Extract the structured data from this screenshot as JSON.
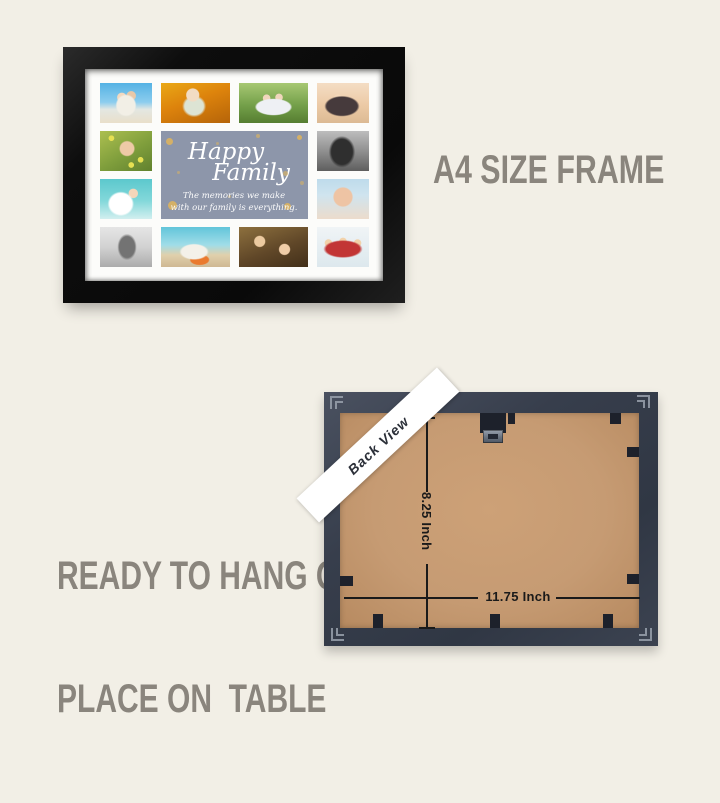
{
  "theme": {
    "page_bg": "#f2efe6",
    "mat_white": "#fcfcfa",
    "panel_blue": "#8d96aa",
    "gold": "#d4b067",
    "caption_gray": "#8a857d",
    "board_tan": "#c69b73",
    "clip_dark": "#1d212b",
    "line_dark": "#1a1a1a",
    "ribbon_white": "#ffffff",
    "ribbon_text": "#2b2f38",
    "metal": "#9aa2ad"
  },
  "front": {
    "panel": {
      "title_line1": "Happy",
      "title_line2": "Family",
      "subtitle_line1": "The memories we make",
      "subtitle_line2": "with our family is everything."
    },
    "photos": [
      {
        "name": "beach-couple",
        "style": "background:radial-gradient(ellipse 15px 16px at 50% 56%,#f2efe6 0 60%,transparent 70%),radial-gradient(circle 5px at 42% 36%,#f3d9c0 0 88%,transparent),radial-gradient(circle 5px at 60% 32%,#e8c8a8 0 88%,transparent),linear-gradient(180deg,#55b2e4 0%,#8ccdee 48%,#e3e7e2 66%,#e9dfca 100%)"
      },
      {
        "name": "autumn-toddler",
        "style": "background:radial-gradient(circle 7px at 46% 30%,#f2dcc4 0 88%,transparent),radial-gradient(ellipse 12px 11px at 48% 58%,#dde4d4 0 78%,transparent),linear-gradient(160deg,#eaa816 0%,#dd830c 45%,#b56409 100%)"
      },
      {
        "name": "park-family",
        "style": "background:radial-gradient(ellipse 24px 11px at 50% 60%,#eef0f4 0 70%,transparent 78%),radial-gradient(circle 4px at 40% 38%,#f0d6bc 0 88%,transparent),radial-gradient(circle 4px at 58% 36%,#f0d6bc 0 88%,transparent),linear-gradient(180deg,#a7c873 0%,#74a04a 55%,#567e31 100%)"
      },
      {
        "name": "beach-family-sunset",
        "style": "background:radial-gradient(ellipse 22px 13px at 48% 58%,#463a3c 0 70%,transparent 80%),radial-gradient(circle 4px at 40% 38%,#f4d8ba 0 88%,transparent),linear-gradient(180deg,#f4ddc4 0%,#eccaa6 55%,#dcba94 100%)"
      },
      {
        "name": "flower-girl",
        "style": "background:radial-gradient(circle 8px at 52% 44%,#eecaa6 0 85%,transparent),radial-gradient(circle 3px at 22% 18%,#e6e052 0 88%,transparent),radial-gradient(circle 3px at 78% 72%,#e6e052 0 88%,transparent),radial-gradient(circle 3px at 60% 85%,#e6e052 0 88%,transparent),linear-gradient(150deg,#acbf50 0%,#7f9e3c 55%,#61812e 100%)"
      },
      {
        "name": "bw-kissing-couple",
        "style": "background:radial-gradient(ellipse 15px 18px at 48% 52%,#2f2f2f 0 70%,transparent 88%),linear-gradient(180deg,#bdbdbd 0%,#909090 50%,#5e5e5e 100%)"
      },
      {
        "name": "mom-and-baby",
        "style": "background:radial-gradient(ellipse 15px 14px at 40% 62%,#ffffff 0 75%,transparent 88%),radial-gradient(circle 5px at 64% 36%,#f5d6ba 0 88%,transparent),linear-gradient(180deg,#5cc8cd 0%,#83d8da 55%,#d2efef 100%)"
      },
      {
        "name": "thinking-baby",
        "style": "background:radial-gradient(circle 11px at 50% 45%,#eec4a4 0 82%,transparent 92%),linear-gradient(180deg,#bedbeb 0%,#cfe4ef 40%,#ecdccc 100%)"
      },
      {
        "name": "bw-field-couple",
        "style": "background:radial-gradient(ellipse 11px 15px at 52% 50%,#737373 0 70%,transparent 88%),linear-gradient(180deg,#e5e5e5 0%,#d2d2d2 50%,#ababab 100%)"
      },
      {
        "name": "beach-pillow-couple",
        "style": "background:radial-gradient(ellipse 18px 10px at 48% 62%,#f4f1e9 0 70%,transparent 82%),radial-gradient(ellipse 11px 6px at 56% 82%,#ea7a2e 0 80%,transparent 92%),linear-gradient(180deg,#62c5da 0%,#a0dde8 45%,#e0d0ac 70%,#cfb893 100%)"
      },
      {
        "name": "autumn-kids",
        "style": "background:radial-gradient(circle 6px at 30% 36%,#eccaa0 0 86%,transparent),radial-gradient(circle 6px at 66% 56%,#f0cda8 0 86%,transparent),linear-gradient(160deg,#8d703e 0%,#604728 55%,#422f19 100%)"
      },
      {
        "name": "red-pajama-family",
        "style": "background:radial-gradient(ellipse 24px 11px at 50% 55%,#c23535 0 70%,transparent 82%),radial-gradient(circle 4px at 22% 40%,#f2d2aa 0 86%,transparent),radial-gradient(circle 4px at 50% 36%,#f2d2aa 0 86%,transparent),radial-gradient(circle 4px at 78% 40%,#f2d2aa 0 86%,transparent),linear-gradient(180deg,#f0f4f6 0%,#e4edf1 60%,#dde8ed 100%)"
      }
    ]
  },
  "captions": {
    "size_label": "A4 SIZE FRAME",
    "hang_line1": "READY TO HANG OR",
    "hang_line2": "PLACE ON  TABLE"
  },
  "back": {
    "ribbon_label": "Back View",
    "height_label": "8.25 Inch",
    "width_label": "11.75 Inch"
  }
}
